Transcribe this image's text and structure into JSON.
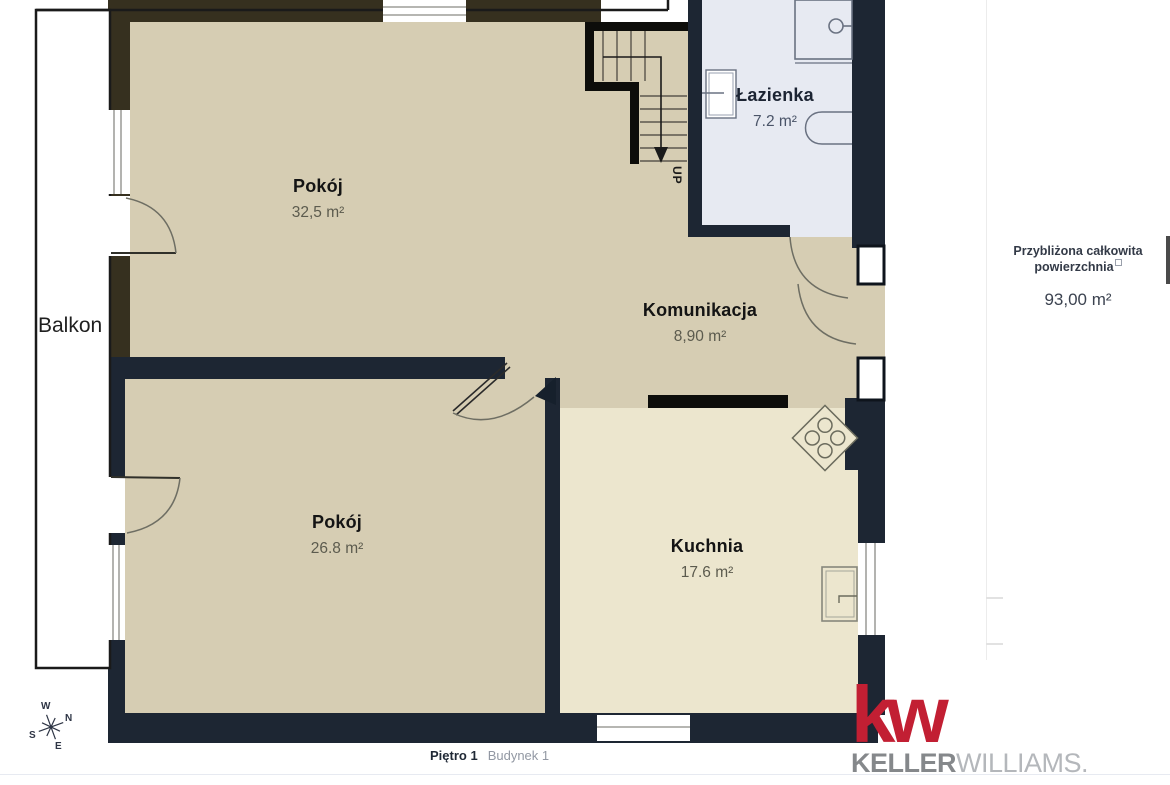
{
  "floorplan": {
    "rooms": [
      {
        "name": "Pokój",
        "area": "32,5 m²"
      },
      {
        "name": "Łazienka",
        "area": "7.2 m²"
      },
      {
        "name": "Komunikacja",
        "area": "8,90 m²"
      },
      {
        "name": "Pokój",
        "area": "26.8 m²"
      },
      {
        "name": "Kuchnia",
        "area": "17.6 m²"
      }
    ],
    "balcony_label": "Balkon",
    "stairs_direction_label": "UP",
    "compass": {
      "north": "N",
      "south": "S",
      "east": "E",
      "west": "W"
    }
  },
  "summary_panel": {
    "total_area_label_line1": "Przybliżona całkowita",
    "total_area_label_line2": "powierzchnia",
    "total_area_value": "93,00 m²"
  },
  "footer": {
    "floor_label": "Piętro 1",
    "building_label": "Budynek 1"
  },
  "branding": {
    "logo_mark": "kw",
    "brand_bold": "KELLER",
    "brand_light": "WILLIAMS."
  },
  "colors": {
    "wall_brown": "#36301f",
    "wall_navy": "#1d2633",
    "wall_black": "#0d0d0a",
    "floor_beige": "#d6cdb3",
    "floor_kitchen": "#ece6ce",
    "floor_bathroom": "#e7eaf2",
    "brand_red": "#c21f33"
  }
}
